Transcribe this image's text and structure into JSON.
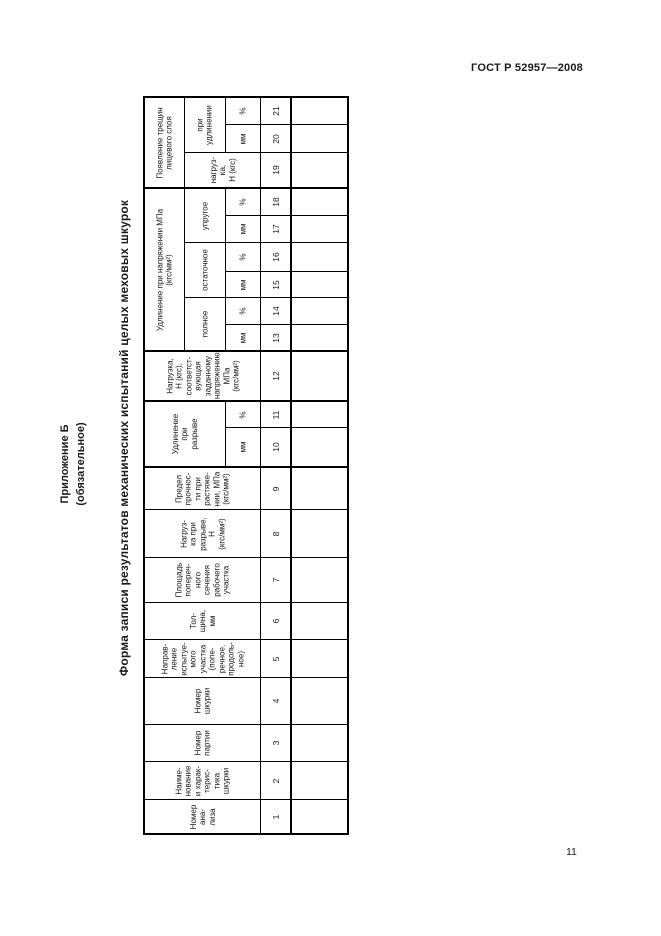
{
  "page": {
    "doc_code": "ГОСТ Р 52957—2008",
    "page_number": "11",
    "appendix_title": "Приложение Б",
    "appendix_subtitle": "(обязательное)",
    "form_title": "Форма записи результатов механических испытаний целых меховых шкурок"
  },
  "table": {
    "header_cells": [
      {
        "name": "group-crack-appearance",
        "r": 0,
        "c": 0,
        "rs": 3,
        "cs": 1,
        "lines": [
          "Появление трещин",
          "лицевого слоя"
        ]
      },
      {
        "name": "sub-at-elongation",
        "r": 0,
        "c": 1,
        "rs": 2,
        "cs": 1,
        "lines": [
          "при",
          "удлинении"
        ]
      },
      {
        "name": "unit-col-21",
        "r": 0,
        "c": 2,
        "rs": 1,
        "cs": 1,
        "lines": [
          "%"
        ]
      },
      {
        "name": "unit-col-20",
        "r": 1,
        "c": 2,
        "rs": 1,
        "cs": 1,
        "lines": [
          "мм"
        ]
      },
      {
        "name": "sub-load-col-19",
        "r": 2,
        "c": 1,
        "rs": 1,
        "cs": 2,
        "lines": [
          "нагруз-",
          "ка,",
          "Н (кгс)"
        ]
      },
      {
        "name": "group-elongation-at-stress",
        "r": 3,
        "c": 0,
        "rs": 6,
        "cs": 1,
        "lines": [
          "Удлинение при напряжении МПа",
          "(кгс/мм²)"
        ]
      },
      {
        "name": "sub-elastic",
        "r": 3,
        "c": 1,
        "rs": 2,
        "cs": 1,
        "lines": [
          "упругое"
        ]
      },
      {
        "name": "unit-col-18",
        "r": 3,
        "c": 2,
        "rs": 1,
        "cs": 1,
        "lines": [
          "%"
        ]
      },
      {
        "name": "unit-col-17",
        "r": 4,
        "c": 2,
        "rs": 1,
        "cs": 1,
        "lines": [
          "мм"
        ]
      },
      {
        "name": "sub-residual",
        "r": 5,
        "c": 1,
        "rs": 2,
        "cs": 1,
        "lines": [
          "остаточное"
        ]
      },
      {
        "name": "unit-col-16",
        "r": 5,
        "c": 2,
        "rs": 1,
        "cs": 1,
        "lines": [
          "%"
        ]
      },
      {
        "name": "unit-col-15",
        "r": 6,
        "c": 2,
        "rs": 1,
        "cs": 1,
        "lines": [
          "мм"
        ]
      },
      {
        "name": "sub-full",
        "r": 7,
        "c": 1,
        "rs": 2,
        "cs": 1,
        "lines": [
          "полное"
        ]
      },
      {
        "name": "unit-col-14",
        "r": 7,
        "c": 2,
        "rs": 1,
        "cs": 1,
        "lines": [
          "%"
        ]
      },
      {
        "name": "unit-col-13",
        "r": 8,
        "c": 2,
        "rs": 1,
        "cs": 1,
        "lines": [
          "мм"
        ]
      },
      {
        "name": "header-col-12",
        "r": 9,
        "c": 0,
        "rs": 1,
        "cs": 3,
        "lines": [
          "Нагрузка,",
          "Н (кгс),",
          "соответст-",
          "вующая",
          "заданному",
          "напряжению",
          "МПа",
          "(кгс/мм²)"
        ]
      },
      {
        "name": "group-elongation-at-break",
        "r": 10,
        "c": 0,
        "rs": 2,
        "cs": 2,
        "lines": [
          "Удлинение",
          "при",
          "разрыве"
        ]
      },
      {
        "name": "unit-col-11",
        "r": 10,
        "c": 2,
        "rs": 1,
        "cs": 1,
        "lines": [
          "%"
        ]
      },
      {
        "name": "unit-col-10",
        "r": 11,
        "c": 2,
        "rs": 1,
        "cs": 1,
        "lines": [
          "мм"
        ]
      },
      {
        "name": "header-col-9",
        "r": 12,
        "c": 0,
        "rs": 1,
        "cs": 3,
        "lines": [
          "Предел",
          "прочнос-",
          "ти при",
          "растяже-",
          "нии, МПа",
          "(кгс/мм²)"
        ]
      },
      {
        "name": "header-col-8",
        "r": 13,
        "c": 0,
        "rs": 1,
        "cs": 3,
        "lines": [
          "Нагруз-",
          "ка при",
          "разрыве,",
          "Н",
          "(кгс/мм²)"
        ]
      },
      {
        "name": "header-col-7",
        "r": 14,
        "c": 0,
        "rs": 1,
        "cs": 3,
        "lines": [
          "Площадь",
          "попереч-",
          "ного",
          "сечения",
          "рабочего",
          "участка"
        ]
      },
      {
        "name": "header-col-6",
        "r": 15,
        "c": 0,
        "rs": 1,
        "cs": 3,
        "lines": [
          "Тол-",
          "щина,",
          "мм"
        ]
      },
      {
        "name": "header-col-5",
        "r": 16,
        "c": 0,
        "rs": 1,
        "cs": 3,
        "lines": [
          "Направ-",
          "ление",
          "испытуе-",
          "мого",
          "участка",
          "(попе-",
          "речное,",
          "продоль-",
          "ное)"
        ]
      },
      {
        "name": "header-col-4",
        "r": 17,
        "c": 0,
        "rs": 1,
        "cs": 3,
        "lines": [
          "Номер",
          "шкурки"
        ]
      },
      {
        "name": "header-col-3",
        "r": 18,
        "c": 0,
        "rs": 1,
        "cs": 3,
        "lines": [
          "Номер",
          "партии"
        ]
      },
      {
        "name": "header-col-2",
        "r": 19,
        "c": 0,
        "rs": 1,
        "cs": 3,
        "lines": [
          "Наиме-",
          "нование",
          "и харак-",
          "терис-",
          "тика",
          "шкурки"
        ]
      },
      {
        "name": "header-col-1",
        "r": 20,
        "c": 0,
        "rs": 1,
        "cs": 3,
        "lines": [
          "Номер",
          "ана-",
          "лиза"
        ]
      }
    ],
    "column_numbers": [
      "21",
      "20",
      "19",
      "18",
      "17",
      "16",
      "15",
      "14",
      "13",
      "12",
      "11",
      "10",
      "9",
      "8",
      "7",
      "6",
      "5",
      "4",
      "3",
      "2",
      "1"
    ]
  }
}
